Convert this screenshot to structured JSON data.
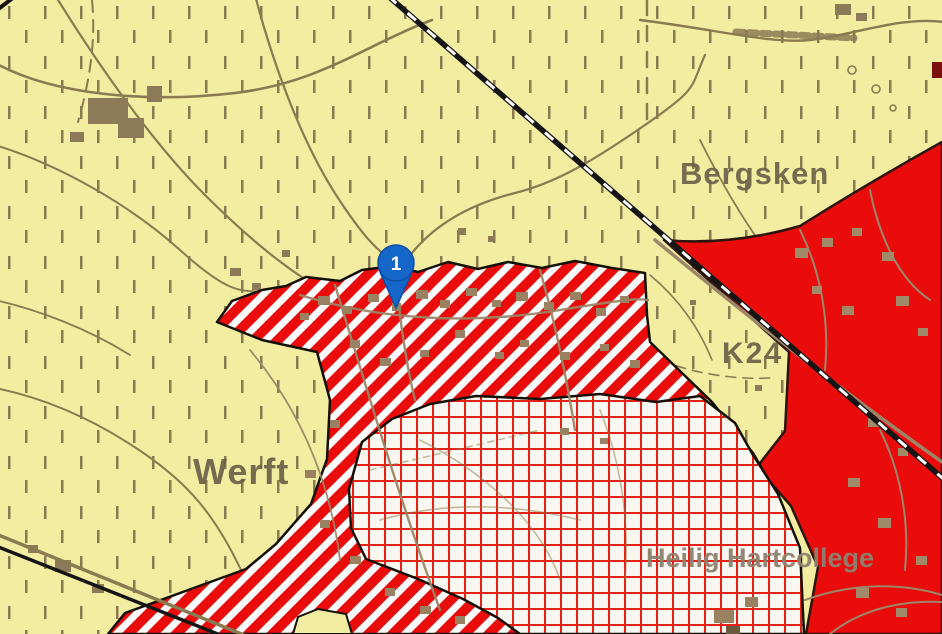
{
  "map": {
    "labels": {
      "bergsken": "Bergsken",
      "werft": "Werft",
      "k24": "K24",
      "heilig_hartcollege": "Heilig Hartcollege"
    },
    "marker": {
      "label": "1",
      "color": "#1467c8",
      "border_color": "#0a4fa6"
    },
    "colors": {
      "agriculture_yellow": "#f3eda1",
      "zone_red": "#ea0b0b",
      "stripe_white": "#ffffff",
      "crosshatch_bg": "#faf7f0",
      "crosshatch_grid_red": "#e52015",
      "topo_brown": "#8a7a52",
      "building_brown": "#937f5e",
      "railway_black": "#151515",
      "label_brown": "#6b6149"
    },
    "zones": {
      "background": "yellow-hatched-zone",
      "right": "solid-red-zone",
      "center": "red-white-striped-zone",
      "center_bottom": "red-crosshatch-zone"
    }
  }
}
